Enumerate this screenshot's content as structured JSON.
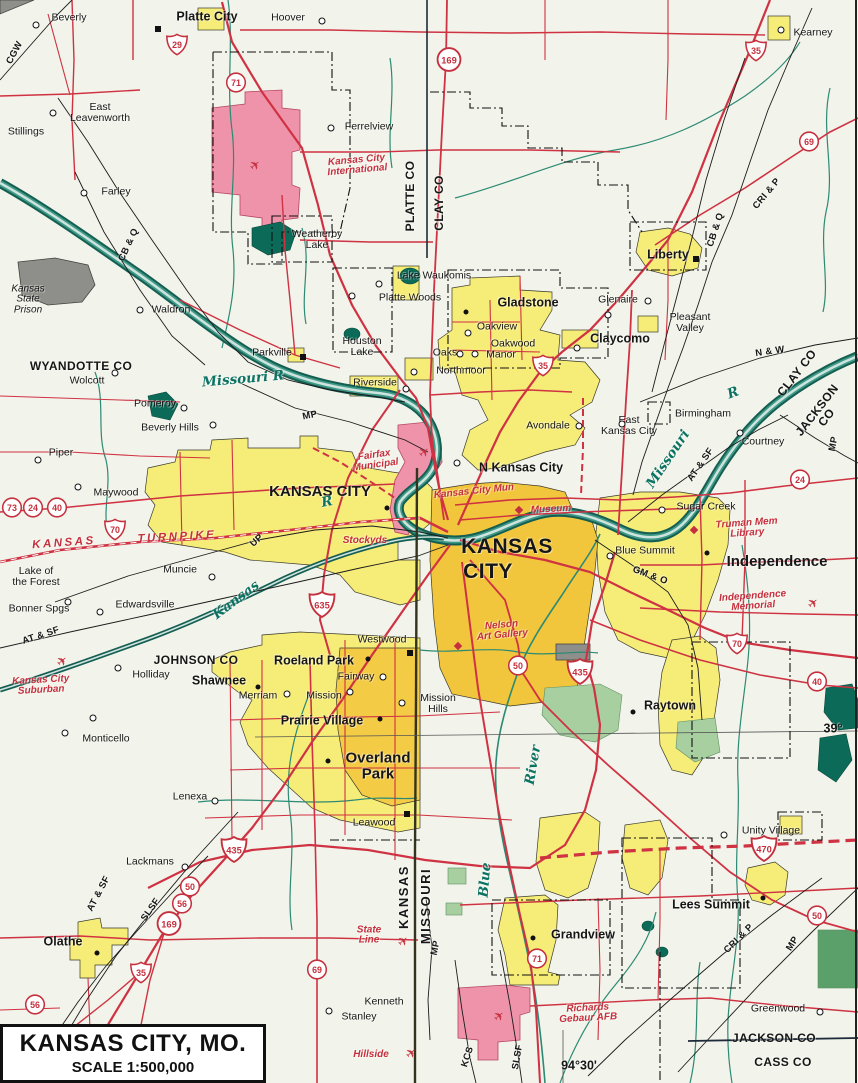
{
  "title_box": {
    "title": "KANSAS CITY, MO.",
    "scale": "SCALE 1:500,000"
  },
  "icons": {
    "airplane": "✈"
  },
  "colors": {
    "background": "#f2f3ea",
    "urban_yellow": "#f6ec78",
    "urban_core_orange": "#f2c63c",
    "airport_pink": "#ef93ab",
    "water_teal": "#0e6e5f",
    "road_red": "#cf3242",
    "rail_black": "#1b1b1b",
    "park_green": "#a8cfa0",
    "prison_gray": "#8e8e8a",
    "poi_red": "#c5303e",
    "river_label_teal": "#0c7363"
  },
  "labels": [
    {
      "t": "Beverly",
      "x": 69,
      "y": 18,
      "c": "town"
    },
    {
      "t": "Platte City",
      "x": 207,
      "y": 17,
      "c": "city"
    },
    {
      "t": "Hoover",
      "x": 288,
      "y": 18,
      "c": "town"
    },
    {
      "t": "Kearney",
      "x": 813,
      "y": 33,
      "c": "town"
    },
    {
      "t": "East\nLeavenworth",
      "x": 100,
      "y": 113,
      "c": "town"
    },
    {
      "t": "Ferrelview",
      "x": 369,
      "y": 127,
      "c": "town"
    },
    {
      "t": "Stillings",
      "x": 26,
      "y": 132,
      "c": "town"
    },
    {
      "t": "Farley",
      "x": 116,
      "y": 192,
      "c": "town"
    },
    {
      "t": "Kansas City\nInternational",
      "x": 357,
      "y": 166,
      "c": "poi",
      "r": -5
    },
    {
      "t": "Weatherby\nLake",
      "x": 317,
      "y": 240,
      "c": "town"
    },
    {
      "t": "Liberty",
      "x": 668,
      "y": 255,
      "c": "city"
    },
    {
      "t": "Lake Waukomis",
      "x": 434,
      "y": 276,
      "c": "town"
    },
    {
      "t": "Platte Woods",
      "x": 410,
      "y": 298,
      "c": "town"
    },
    {
      "t": "Gladstone",
      "x": 528,
      "y": 303,
      "c": "city"
    },
    {
      "t": "Glenaire",
      "x": 618,
      "y": 300,
      "c": "town"
    },
    {
      "t": "Waldron",
      "x": 171,
      "y": 310,
      "c": "town"
    },
    {
      "t": "Pleasant\nValley",
      "x": 690,
      "y": 323,
      "c": "town"
    },
    {
      "t": "Oakview",
      "x": 497,
      "y": 327,
      "c": "town"
    },
    {
      "t": "Houston\nLake",
      "x": 362,
      "y": 347,
      "c": "town"
    },
    {
      "t": "Claycomo",
      "x": 620,
      "y": 339,
      "c": "city"
    },
    {
      "t": "Kansas\nState\nPrison",
      "x": 28,
      "y": 300,
      "c": "ital"
    },
    {
      "t": "Oakwood",
      "x": 513,
      "y": 344,
      "c": "town"
    },
    {
      "t": "Oaks",
      "x": 445,
      "y": 353,
      "c": "town"
    },
    {
      "t": "Manor",
      "x": 501,
      "y": 355,
      "c": "town"
    },
    {
      "t": "Parkville",
      "x": 272,
      "y": 353,
      "c": "town"
    },
    {
      "t": "Northmoor",
      "x": 461,
      "y": 371,
      "c": "town"
    },
    {
      "t": "Riverside",
      "x": 375,
      "y": 383,
      "c": "town"
    },
    {
      "t": "WYANDOTTE CO",
      "x": 81,
      "y": 366,
      "c": "county"
    },
    {
      "t": "Wolcott",
      "x": 87,
      "y": 381,
      "c": "town"
    },
    {
      "t": "Birmingham",
      "x": 703,
      "y": 414,
      "c": "town"
    },
    {
      "t": "East\nKansas City",
      "x": 629,
      "y": 426,
      "c": "town"
    },
    {
      "t": "Avondale",
      "x": 548,
      "y": 426,
      "c": "town"
    },
    {
      "t": "Pomeroy",
      "x": 155,
      "y": 404,
      "c": "town"
    },
    {
      "t": "Beverly Hills",
      "x": 170,
      "y": 428,
      "c": "town"
    },
    {
      "t": "Courtney",
      "x": 763,
      "y": 442,
      "c": "town"
    },
    {
      "t": "N Kansas City",
      "x": 521,
      "y": 468,
      "c": "city"
    },
    {
      "t": "Piper",
      "x": 61,
      "y": 453,
      "c": "town"
    },
    {
      "t": "KANSAS CITY",
      "x": 320,
      "y": 492,
      "c": "citylg"
    },
    {
      "t": "Maywood",
      "x": 116,
      "y": 493,
      "c": "town"
    },
    {
      "t": "Sugar Creek",
      "x": 706,
      "y": 507,
      "c": "town"
    },
    {
      "t": "KANSAS",
      "x": 507,
      "y": 547,
      "c": "cityxl"
    },
    {
      "t": "CITY",
      "x": 488,
      "y": 572,
      "c": "cityxl"
    },
    {
      "t": "Blue Summit",
      "x": 645,
      "y": 551,
      "c": "town"
    },
    {
      "t": "Independence",
      "x": 777,
      "y": 562,
      "c": "citylg"
    },
    {
      "t": "Muncie",
      "x": 180,
      "y": 570,
      "c": "town"
    },
    {
      "t": "Lake of\nthe Forest",
      "x": 36,
      "y": 577,
      "c": "town"
    },
    {
      "t": "Edwardsville",
      "x": 145,
      "y": 605,
      "c": "town"
    },
    {
      "t": "Bonner Spgs",
      "x": 39,
      "y": 609,
      "c": "town"
    },
    {
      "t": "Westwood",
      "x": 382,
      "y": 640,
      "c": "town"
    },
    {
      "t": "JOHNSON CO",
      "x": 196,
      "y": 660,
      "c": "county"
    },
    {
      "t": "Roeland Park",
      "x": 314,
      "y": 661,
      "c": "city"
    },
    {
      "t": "Holliday",
      "x": 151,
      "y": 675,
      "c": "town"
    },
    {
      "t": "Shawnee",
      "x": 219,
      "y": 681,
      "c": "city"
    },
    {
      "t": "Fairway",
      "x": 356,
      "y": 677,
      "c": "town"
    },
    {
      "t": "Merriam",
      "x": 258,
      "y": 696,
      "c": "town"
    },
    {
      "t": "Mission",
      "x": 324,
      "y": 696,
      "c": "town"
    },
    {
      "t": "Mission\nHills",
      "x": 438,
      "y": 704,
      "c": "town"
    },
    {
      "t": "Raytown",
      "x": 670,
      "y": 706,
      "c": "city"
    },
    {
      "t": "Prairie Village",
      "x": 322,
      "y": 721,
      "c": "city"
    },
    {
      "t": "39°",
      "x": 833,
      "y": 729,
      "c": "coord"
    },
    {
      "t": "Monticello",
      "x": 106,
      "y": 739,
      "c": "town"
    },
    {
      "t": "Overland\nPark",
      "x": 378,
      "y": 766,
      "c": "citylg"
    },
    {
      "t": "Lenexa",
      "x": 190,
      "y": 797,
      "c": "town"
    },
    {
      "t": "Leawood",
      "x": 374,
      "y": 823,
      "c": "town"
    },
    {
      "t": "Unity Village",
      "x": 771,
      "y": 831,
      "c": "town"
    },
    {
      "t": "Lackmans",
      "x": 150,
      "y": 862,
      "c": "town"
    },
    {
      "t": "Lees Summit",
      "x": 711,
      "y": 905,
      "c": "city"
    },
    {
      "t": "Grandview",
      "x": 583,
      "y": 935,
      "c": "city"
    },
    {
      "t": "Olathe",
      "x": 63,
      "y": 942,
      "c": "city"
    },
    {
      "t": "Kenneth",
      "x": 384,
      "y": 1002,
      "c": "town"
    },
    {
      "t": "Stanley",
      "x": 359,
      "y": 1017,
      "c": "town"
    },
    {
      "t": "Greenwood",
      "x": 778,
      "y": 1009,
      "c": "town"
    },
    {
      "t": "JACKSON CO",
      "x": 774,
      "y": 1038,
      "c": "county"
    },
    {
      "t": "CASS CO",
      "x": 783,
      "y": 1062,
      "c": "county"
    },
    {
      "t": "PLATTE CO",
      "x": 410,
      "y": 196,
      "c": "county",
      "r": -90
    },
    {
      "t": "CLAY CO",
      "x": 439,
      "y": 203,
      "c": "county",
      "r": -90
    },
    {
      "t": "CLAY CO",
      "x": 797,
      "y": 373,
      "c": "county",
      "r": -52
    },
    {
      "t": "JACKSON CO",
      "x": 822,
      "y": 414,
      "c": "county",
      "r": -52
    },
    {
      "t": "KANSAS",
      "x": 404,
      "y": 897,
      "c": "state",
      "r": -90
    },
    {
      "t": "MISSOURI",
      "x": 426,
      "y": 906,
      "c": "state",
      "r": -90
    },
    {
      "t": "CGW",
      "x": 15,
      "y": 53,
      "c": "rr",
      "r": -62
    },
    {
      "t": "CB & Q",
      "x": 129,
      "y": 245,
      "c": "rr",
      "r": -65
    },
    {
      "t": "CRI & P",
      "x": 767,
      "y": 194,
      "c": "rr",
      "r": -50
    },
    {
      "t": "CB & Q",
      "x": 716,
      "y": 230,
      "c": "rr",
      "r": -72
    },
    {
      "t": "N & W",
      "x": 770,
      "y": 352,
      "c": "rr",
      "r": -8
    },
    {
      "t": "MP",
      "x": 310,
      "y": 416,
      "c": "rr",
      "r": -12
    },
    {
      "t": "MP",
      "x": 834,
      "y": 444,
      "c": "rr",
      "r": -78
    },
    {
      "t": "AT & SF",
      "x": 701,
      "y": 465,
      "c": "rr",
      "r": -55
    },
    {
      "t": "UP",
      "x": 257,
      "y": 541,
      "c": "rr",
      "r": -42
    },
    {
      "t": "AT & SF",
      "x": 41,
      "y": 636,
      "c": "rr",
      "r": -18
    },
    {
      "t": "GM & O",
      "x": 650,
      "y": 576,
      "c": "rr",
      "r": 20
    },
    {
      "t": "AT & SF",
      "x": 99,
      "y": 894,
      "c": "rr",
      "r": -62
    },
    {
      "t": "SLSF",
      "x": 151,
      "y": 910,
      "c": "rr",
      "r": -55
    },
    {
      "t": "MP",
      "x": 436,
      "y": 948,
      "c": "rr",
      "r": -78
    },
    {
      "t": "CRI & P",
      "x": 739,
      "y": 939,
      "c": "rr",
      "r": -45
    },
    {
      "t": "MP",
      "x": 793,
      "y": 944,
      "c": "rr",
      "r": -58
    },
    {
      "t": "KCS",
      "x": 468,
      "y": 1057,
      "c": "rr",
      "r": -72
    },
    {
      "t": "SLSF",
      "x": 518,
      "y": 1057,
      "c": "rr",
      "r": -80
    },
    {
      "t": "KANSAS",
      "x": 64,
      "y": 544,
      "c": "tpk",
      "r": -4
    },
    {
      "t": "TURNPIKE",
      "x": 177,
      "y": 538,
      "c": "tpk",
      "r": -3
    },
    {
      "t": "Missouri R",
      "x": 243,
      "y": 379,
      "c": "river",
      "r": -5
    },
    {
      "t": "Missouri",
      "x": 668,
      "y": 459,
      "c": "river",
      "r": -56
    },
    {
      "t": "R",
      "x": 733,
      "y": 393,
      "c": "river",
      "r": -20
    },
    {
      "t": "Kansas",
      "x": 236,
      "y": 600,
      "c": "river",
      "r": -37
    },
    {
      "t": "R",
      "x": 327,
      "y": 502,
      "c": "river",
      "r": -10
    },
    {
      "t": "River",
      "x": 533,
      "y": 765,
      "c": "river",
      "r": -80
    },
    {
      "t": "Blue",
      "x": 485,
      "y": 880,
      "c": "river",
      "r": -85
    },
    {
      "t": "Fairfax\nMunicipal",
      "x": 375,
      "y": 461,
      "c": "poi",
      "r": -8
    },
    {
      "t": "Kansas City Mun",
      "x": 474,
      "y": 492,
      "c": "poi",
      "r": -6
    },
    {
      "t": "Stockyds",
      "x": 365,
      "y": 541,
      "c": "poi"
    },
    {
      "t": "Museum",
      "x": 551,
      "y": 510,
      "c": "poi",
      "r": -3
    },
    {
      "t": "Nelson\nArt Gallery",
      "x": 502,
      "y": 631,
      "c": "poi",
      "r": -5
    },
    {
      "t": "Truman Mem\nLibrary",
      "x": 747,
      "y": 529,
      "c": "poi",
      "r": -4
    },
    {
      "t": "Independence\nMemorial",
      "x": 753,
      "y": 602,
      "c": "poi",
      "r": -4
    },
    {
      "t": "Kansas City\nSuburban",
      "x": 41,
      "y": 686,
      "c": "poi",
      "r": -3
    },
    {
      "t": "State\nLine",
      "x": 369,
      "y": 936,
      "c": "poi"
    },
    {
      "t": "Hillside",
      "x": 371,
      "y": 1055,
      "c": "poi"
    },
    {
      "t": "Richards\nGebaur AFB",
      "x": 588,
      "y": 1014,
      "c": "poi",
      "r": -3
    },
    {
      "t": "94°30'",
      "x": 579,
      "y": 1066,
      "c": "coord"
    }
  ],
  "markers": [
    {
      "m": "sq",
      "x": 158,
      "y": 29
    },
    {
      "m": "sq",
      "x": 696,
      "y": 259
    },
    {
      "m": "sq",
      "x": 303,
      "y": 357
    },
    {
      "m": "sq",
      "x": 407,
      "y": 814
    },
    {
      "m": "sq",
      "x": 410,
      "y": 653
    },
    {
      "m": "dot",
      "x": 466,
      "y": 312
    },
    {
      "m": "dot",
      "x": 707,
      "y": 553
    },
    {
      "m": "dot",
      "x": 633,
      "y": 712
    },
    {
      "m": "dot",
      "x": 763,
      "y": 898
    },
    {
      "m": "dot",
      "x": 533,
      "y": 938
    },
    {
      "m": "dot",
      "x": 328,
      "y": 761
    },
    {
      "m": "dot",
      "x": 258,
      "y": 687
    },
    {
      "m": "dot",
      "x": 380,
      "y": 719
    },
    {
      "m": "dot",
      "x": 368,
      "y": 659
    },
    {
      "m": "dot",
      "x": 97,
      "y": 953
    },
    {
      "m": "dot",
      "x": 387,
      "y": 508
    },
    {
      "m": "ring",
      "x": 36,
      "y": 25
    },
    {
      "m": "ring",
      "x": 322,
      "y": 21
    },
    {
      "m": "ring",
      "x": 53,
      "y": 113
    },
    {
      "m": "ring",
      "x": 84,
      "y": 193
    },
    {
      "m": "ring",
      "x": 331,
      "y": 128
    },
    {
      "m": "ring",
      "x": 140,
      "y": 310
    },
    {
      "m": "ring",
      "x": 379,
      "y": 284
    },
    {
      "m": "ring",
      "x": 352,
      "y": 296
    },
    {
      "m": "ring",
      "x": 468,
      "y": 333
    },
    {
      "m": "ring",
      "x": 460,
      "y": 354
    },
    {
      "m": "ring",
      "x": 475,
      "y": 354
    },
    {
      "m": "ring",
      "x": 414,
      "y": 372
    },
    {
      "m": "ring",
      "x": 648,
      "y": 301
    },
    {
      "m": "ring",
      "x": 608,
      "y": 315
    },
    {
      "m": "ring",
      "x": 577,
      "y": 348
    },
    {
      "m": "ring",
      "x": 781,
      "y": 30
    },
    {
      "m": "ring",
      "x": 740,
      "y": 433
    },
    {
      "m": "ring",
      "x": 579,
      "y": 426
    },
    {
      "m": "ring",
      "x": 662,
      "y": 510
    },
    {
      "m": "ring",
      "x": 610,
      "y": 556
    },
    {
      "m": "ring",
      "x": 457,
      "y": 463
    },
    {
      "m": "ring",
      "x": 724,
      "y": 835
    },
    {
      "m": "ring",
      "x": 820,
      "y": 1012
    },
    {
      "m": "ring",
      "x": 185,
      "y": 867
    },
    {
      "m": "ring",
      "x": 215,
      "y": 801
    },
    {
      "m": "ring",
      "x": 329,
      "y": 1011
    },
    {
      "m": "ring",
      "x": 287,
      "y": 694
    },
    {
      "m": "ring",
      "x": 350,
      "y": 692
    },
    {
      "m": "ring",
      "x": 383,
      "y": 677
    },
    {
      "m": "ring",
      "x": 402,
      "y": 703
    },
    {
      "m": "ring",
      "x": 212,
      "y": 577
    },
    {
      "m": "ring",
      "x": 100,
      "y": 612
    },
    {
      "m": "ring",
      "x": 68,
      "y": 602
    },
    {
      "m": "ring",
      "x": 93,
      "y": 718
    },
    {
      "m": "ring",
      "x": 65,
      "y": 733
    },
    {
      "m": "ring",
      "x": 118,
      "y": 668
    },
    {
      "m": "ring",
      "x": 115,
      "y": 373
    },
    {
      "m": "ring",
      "x": 184,
      "y": 408
    },
    {
      "m": "ring",
      "x": 213,
      "y": 425
    },
    {
      "m": "ring",
      "x": 38,
      "y": 460
    },
    {
      "m": "ring",
      "x": 78,
      "y": 487
    },
    {
      "m": "ring",
      "x": 406,
      "y": 389
    },
    {
      "m": "ring",
      "x": 622,
      "y": 424
    },
    {
      "m": "dia",
      "x": 519,
      "y": 510
    },
    {
      "m": "dia",
      "x": 694,
      "y": 530
    },
    {
      "m": "dia",
      "x": 458,
      "y": 646
    }
  ],
  "shields": [
    {
      "k": "i",
      "n": "29",
      "x": 177,
      "y": 47
    },
    {
      "k": "i",
      "n": "35",
      "x": 756,
      "y": 53
    },
    {
      "k": "i",
      "n": "35",
      "x": 543,
      "y": 368
    },
    {
      "k": "i",
      "n": "70",
      "x": 115,
      "y": 532
    },
    {
      "k": "i",
      "n": "70",
      "x": 737,
      "y": 646
    },
    {
      "k": "i",
      "n": "435",
      "x": 580,
      "y": 674
    },
    {
      "k": "i",
      "n": "635",
      "x": 322,
      "y": 607
    },
    {
      "k": "i",
      "n": "435",
      "x": 234,
      "y": 852
    },
    {
      "k": "i",
      "n": "35",
      "x": 141,
      "y": 975
    },
    {
      "k": "i",
      "n": "470",
      "x": 764,
      "y": 851
    },
    {
      "k": "u",
      "n": "71",
      "x": 236,
      "y": 85
    },
    {
      "k": "u",
      "n": "169",
      "x": 449,
      "y": 62
    },
    {
      "k": "u",
      "n": "69",
      "x": 809,
      "y": 144
    },
    {
      "k": "u",
      "n": "24",
      "x": 800,
      "y": 482
    },
    {
      "k": "u",
      "n": "73",
      "x": 12,
      "y": 510
    },
    {
      "k": "u",
      "n": "24",
      "x": 33,
      "y": 510
    },
    {
      "k": "u",
      "n": "40",
      "x": 57,
      "y": 510
    },
    {
      "k": "u",
      "n": "50",
      "x": 518,
      "y": 668
    },
    {
      "k": "u",
      "n": "40",
      "x": 817,
      "y": 684
    },
    {
      "k": "u",
      "n": "50",
      "x": 190,
      "y": 889
    },
    {
      "k": "u",
      "n": "56",
      "x": 182,
      "y": 906
    },
    {
      "k": "u",
      "n": "169",
      "x": 169,
      "y": 926
    },
    {
      "k": "u",
      "n": "69",
      "x": 317,
      "y": 972
    },
    {
      "k": "u",
      "n": "56",
      "x": 35,
      "y": 1007
    },
    {
      "k": "u",
      "n": "50",
      "x": 817,
      "y": 918
    },
    {
      "k": "u",
      "n": "71",
      "x": 537,
      "y": 961
    }
  ],
  "planes": [
    {
      "x": 255,
      "y": 165
    },
    {
      "x": 424,
      "y": 452
    },
    {
      "x": 62,
      "y": 661
    },
    {
      "x": 813,
      "y": 603
    },
    {
      "x": 403,
      "y": 941
    },
    {
      "x": 411,
      "y": 1053
    },
    {
      "x": 499,
      "y": 1016
    }
  ]
}
